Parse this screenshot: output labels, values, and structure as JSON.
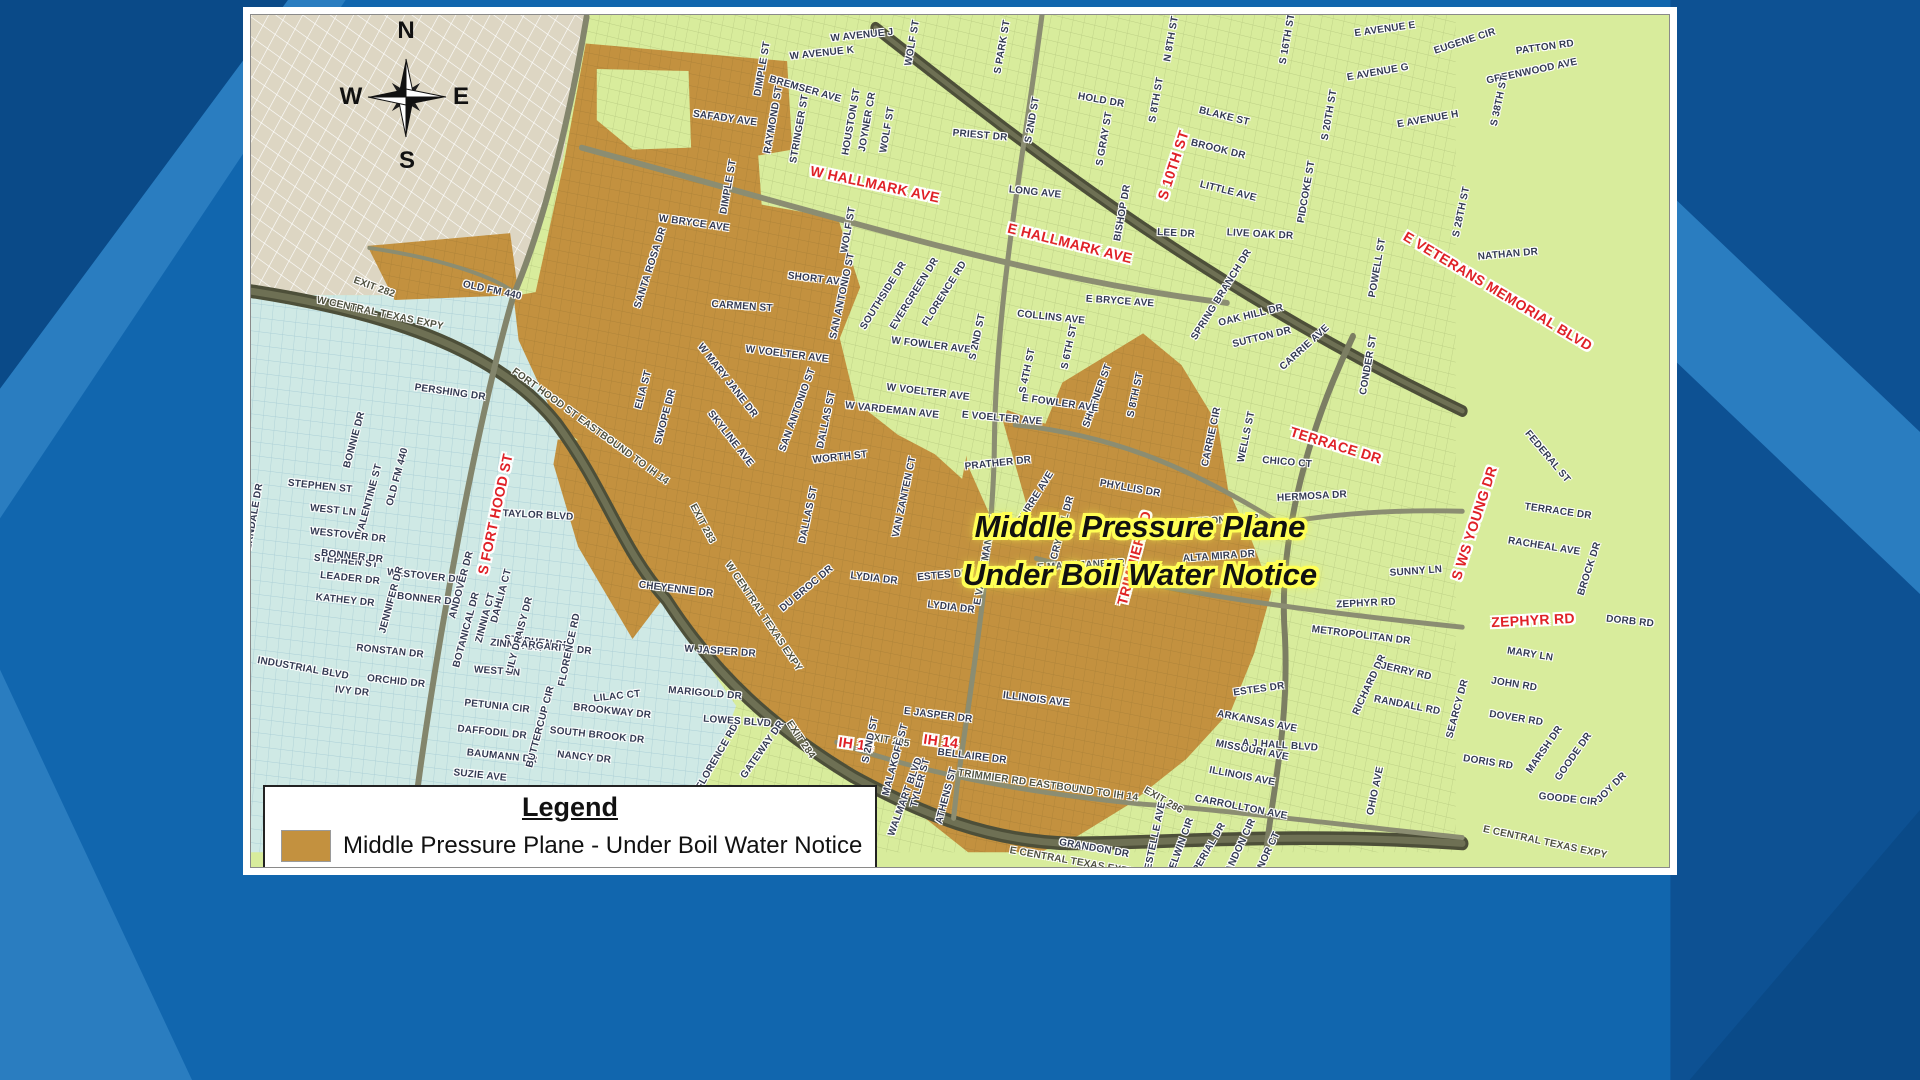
{
  "background": {
    "base": "#1166ae",
    "dark": "#0a4a88",
    "light": "#2a7dc0"
  },
  "map": {
    "compass": {
      "n": "N",
      "w": "W",
      "e": "E",
      "s": "S"
    },
    "notice": {
      "line1": "Middle Pressure Plane",
      "line2": "Under Boil Water Notice",
      "text_color": "#111111",
      "halo_color": "#ffff55"
    },
    "legend": {
      "title": "Legend",
      "item": "Middle Pressure Plane - Under Boil Water Notice",
      "swatch": "#c3913f"
    },
    "colors": {
      "boil_area": "#c3913f",
      "green_area": "#d8ec9c",
      "blue_area": "#cfe9e5",
      "beige_area": "#ddd6c3",
      "highway": "#4d4f39",
      "road": "#8b8d72",
      "red_label": "#e02127"
    },
    "labels": [
      [
        "EXIT 282",
        374,
        288,
        20,
        "ex"
      ],
      [
        "OLD FM 440",
        492,
        291,
        12,
        "st"
      ],
      [
        "W CENTRAL TEXAS EXPY",
        380,
        314,
        12,
        "ex"
      ],
      [
        "FORT HOOD ST EASTBOUND TO IH 14",
        590,
        427,
        36,
        "ex"
      ],
      [
        "EXIT 283",
        702,
        524,
        62,
        "ex"
      ],
      [
        "EXIT 284",
        800,
        740,
        56,
        "ex"
      ],
      [
        "W CENTRAL TEXAS EXPY",
        763,
        617,
        56,
        "ex"
      ],
      [
        "EXIT 285",
        888,
        741,
        10,
        "ex"
      ],
      [
        "EXIT 286",
        1163,
        801,
        30,
        "ex"
      ],
      [
        "TRIMMIER RD EASTBOUND TO IH 14",
        1048,
        786,
        8,
        "ex"
      ],
      [
        "E CENTRAL TEXAS EXPY",
        1072,
        862,
        10,
        "ex"
      ],
      [
        "E CENTRAL TEXAS EXPY",
        1545,
        843,
        12,
        "ex"
      ],
      [
        "W HALLMARK AVE",
        875,
        184,
        12,
        "hw"
      ],
      [
        "E HALLMARK AVE",
        1070,
        243,
        14,
        "hw"
      ],
      [
        "S 10TH ST",
        1173,
        165,
        -72,
        "hw"
      ],
      [
        "E VETERANS MEMORIAL BLVD",
        1498,
        291,
        31,
        "hw"
      ],
      [
        "TERRACE DR",
        1336,
        445,
        17,
        "hw"
      ],
      [
        "S WS YOUNG DR",
        1474,
        523,
        -72,
        "hw"
      ],
      [
        "ZEPHYR RD",
        1533,
        620,
        -3,
        "hw"
      ],
      [
        "TRIMMIER RD",
        1134,
        558,
        -75,
        "hw"
      ],
      [
        "S FORT HOOD ST",
        495,
        514,
        -78,
        "hw"
      ],
      [
        "IH 14",
        856,
        744,
        8,
        "hw"
      ],
      [
        "IH 14",
        941,
        741,
        8,
        "hw"
      ],
      [
        "W AVENUE J",
        862,
        36,
        -6,
        "st"
      ],
      [
        "W AVENUE K",
        822,
        54,
        -6,
        "st"
      ],
      [
        "WOLF ST",
        913,
        43,
        -80,
        "st"
      ],
      [
        "DIMPLE ST",
        763,
        69,
        -80,
        "st"
      ],
      [
        "BREMSER AVE",
        805,
        90,
        16,
        "st"
      ],
      [
        "SAFADY AVE",
        725,
        119,
        8,
        "st"
      ],
      [
        "RAYMOND ST",
        774,
        120,
        -80,
        "st"
      ],
      [
        "STRINGER ST",
        800,
        129,
        -80,
        "st"
      ],
      [
        "HOUSTON ST",
        852,
        122,
        -80,
        "st"
      ],
      [
        "JOYNER CR",
        868,
        122,
        -80,
        "st"
      ],
      [
        "WOLF ST",
        888,
        130,
        -80,
        "st"
      ],
      [
        "PRIEST DR",
        980,
        136,
        5,
        "st"
      ],
      [
        "S PARK ST",
        1003,
        47,
        -80,
        "st"
      ],
      [
        "N 8TH ST",
        1172,
        39,
        -80,
        "st"
      ],
      [
        "S 16TH ST",
        1288,
        39,
        -80,
        "st"
      ],
      [
        "S 2ND ST",
        1033,
        120,
        -80,
        "st"
      ],
      [
        "HOLD DR",
        1101,
        101,
        10,
        "st"
      ],
      [
        "S GRAY ST",
        1105,
        139,
        -80,
        "st"
      ],
      [
        "S 8TH ST",
        1157,
        100,
        -80,
        "st"
      ],
      [
        "BLAKE ST",
        1224,
        117,
        14,
        "st"
      ],
      [
        "BROOK DR",
        1218,
        150,
        14,
        "st"
      ],
      [
        "LITTLE AVE",
        1228,
        192,
        14,
        "st"
      ],
      [
        "S 20TH ST",
        1330,
        115,
        -80,
        "st"
      ],
      [
        "PIDCOKE ST",
        1307,
        192,
        -80,
        "st"
      ],
      [
        "LONG AVE",
        1035,
        193,
        6,
        "st"
      ],
      [
        "BISHOP DR",
        1123,
        213,
        -80,
        "st"
      ],
      [
        "LEE DR",
        1176,
        234,
        3,
        "st"
      ],
      [
        "LIVE OAK DR",
        1260,
        235,
        3,
        "st"
      ],
      [
        "E AVENUE E",
        1385,
        30,
        -8,
        "st"
      ],
      [
        "EUGENE CIR",
        1465,
        42,
        -18,
        "st"
      ],
      [
        "PATTON RD",
        1545,
        48,
        -8,
        "st"
      ],
      [
        "E AVENUE G",
        1378,
        73,
        -10,
        "st"
      ],
      [
        "GREENWOOD AVE",
        1532,
        72,
        -12,
        "st"
      ],
      [
        "E AVENUE H",
        1428,
        120,
        -10,
        "st"
      ],
      [
        "S 38TH ST",
        1500,
        101,
        -78,
        "st"
      ],
      [
        "S 28TH ST",
        1462,
        212,
        -78,
        "st"
      ],
      [
        "POWELL ST",
        1378,
        268,
        -80,
        "st"
      ],
      [
        "NATHAN DR",
        1508,
        255,
        -5,
        "st"
      ],
      [
        "CONDER ST",
        1369,
        365,
        -80,
        "st"
      ],
      [
        "E BRYCE AVE",
        1120,
        302,
        4,
        "st"
      ],
      [
        "COLLINS AVE",
        1051,
        318,
        6,
        "st"
      ],
      [
        "S 4TH ST",
        1028,
        371,
        -78,
        "st"
      ],
      [
        "S 6TH ST",
        1070,
        347,
        -78,
        "st"
      ],
      [
        "S 8TH ST",
        1136,
        395,
        -78,
        "st"
      ],
      [
        "SHOFNER ST",
        1098,
        396,
        -70,
        "st"
      ],
      [
        "E FOWLER AVE",
        1060,
        404,
        8,
        "st"
      ],
      [
        "SPRING BRANCH DR",
        1222,
        295,
        -58,
        "st"
      ],
      [
        "OAK HILL DR",
        1251,
        316,
        -14,
        "st"
      ],
      [
        "SUTTON DR",
        1262,
        338,
        -14,
        "st"
      ],
      [
        "CARRIE AVE",
        1305,
        348,
        -42,
        "st"
      ],
      [
        "FEDERAL ST",
        1547,
        457,
        50,
        "st"
      ],
      [
        "TERRACE DR",
        1558,
        512,
        8,
        "st"
      ],
      [
        "RACHEAL AVE",
        1544,
        547,
        9,
        "st"
      ],
      [
        "BROCK DR",
        1590,
        569,
        -72,
        "st"
      ],
      [
        "SUNNY LN",
        1416,
        572,
        -4,
        "st"
      ],
      [
        "MARY LN",
        1530,
        655,
        9,
        "st"
      ],
      [
        "JOHN RD",
        1514,
        685,
        9,
        "st"
      ],
      [
        "DOVER RD",
        1516,
        719,
        9,
        "st"
      ],
      [
        "DORIS RD",
        1488,
        763,
        9,
        "st"
      ],
      [
        "MARSH DR",
        1545,
        750,
        -55,
        "st"
      ],
      [
        "GOODE DR",
        1574,
        757,
        -55,
        "st"
      ],
      [
        "GOODE CIR",
        1568,
        800,
        6,
        "st"
      ],
      [
        "JOY DR",
        1612,
        788,
        -45,
        "st"
      ],
      [
        "DORB RD",
        1630,
        622,
        6,
        "st"
      ],
      [
        "SANTA ROSA DR",
        651,
        268,
        -72,
        "st"
      ],
      [
        "W BRYCE AVE",
        694,
        224,
        8,
        "st"
      ],
      [
        "DIMPLE ST",
        729,
        187,
        -80,
        "st"
      ],
      [
        "SHORT AVE",
        817,
        280,
        7,
        "st"
      ],
      [
        "CARMEN ST",
        742,
        307,
        4,
        "st"
      ],
      [
        "SAN ANTONIO ST",
        843,
        296,
        -78,
        "st"
      ],
      [
        "SAN ANTONIO ST",
        798,
        410,
        -70,
        "st"
      ],
      [
        "W VOELTER AVE",
        787,
        355,
        7,
        "st"
      ],
      [
        "W VOELTER AVE",
        928,
        393,
        7,
        "st"
      ],
      [
        "W MARY JANE DR",
        727,
        381,
        52,
        "st"
      ],
      [
        "SWOPE DR",
        666,
        417,
        -75,
        "st"
      ],
      [
        "ELIA ST",
        644,
        390,
        -75,
        "st"
      ],
      [
        "SKYLINE AVE",
        730,
        439,
        52,
        "st"
      ],
      [
        "DALLAS ST",
        827,
        420,
        -78,
        "st"
      ],
      [
        "DALLAS ST",
        809,
        515,
        -78,
        "st"
      ],
      [
        "WORTH ST",
        840,
        458,
        -6,
        "st"
      ],
      [
        "W VARDEMAN AVE",
        892,
        411,
        6,
        "st"
      ],
      [
        "VAN ZANTEN CT",
        905,
        497,
        -78,
        "st"
      ],
      [
        "SOUTHSIDE DR",
        884,
        296,
        -58,
        "st"
      ],
      [
        "EVERGREEN DR",
        915,
        294,
        -58,
        "st"
      ],
      [
        "FLORENCE RD",
        945,
        294,
        -58,
        "st"
      ],
      [
        "WOLF ST",
        849,
        230,
        -80,
        "st"
      ],
      [
        "W FOWLER AVE",
        931,
        346,
        7,
        "st"
      ],
      [
        "PRATHER DR",
        998,
        464,
        -6,
        "st"
      ],
      [
        "CURRE AVE",
        1036,
        498,
        -58,
        "st"
      ],
      [
        "CRYSTAL DR",
        1063,
        528,
        -75,
        "st"
      ],
      [
        "E MARY JANE DR",
        1081,
        566,
        -3,
        "st"
      ],
      [
        "LYDIA DR",
        874,
        579,
        7,
        "st"
      ],
      [
        "LYDIA DR",
        951,
        608,
        7,
        "st"
      ],
      [
        "ESTES DR",
        943,
        576,
        -5,
        "st"
      ],
      [
        "ESTES DR",
        1259,
        690,
        -8,
        "st"
      ],
      [
        "E VARDEMAN AVE",
        986,
        560,
        -80,
        "st"
      ],
      [
        "E VOELTER AVE",
        1002,
        419,
        5,
        "st"
      ],
      [
        "S 2ND ST",
        978,
        337,
        -78,
        "st"
      ],
      [
        "S 2ND ST",
        871,
        740,
        -78,
        "st"
      ],
      [
        "E JASPER DR",
        938,
        716,
        7,
        "st"
      ],
      [
        "W JASPER DR",
        720,
        652,
        4,
        "st"
      ],
      [
        "BELLAIRE DR",
        972,
        757,
        7,
        "st"
      ],
      [
        "MALAKOFF ST",
        896,
        760,
        -75,
        "st"
      ],
      [
        "TYLER ST",
        921,
        783,
        -75,
        "st"
      ],
      [
        "ATHENS ST",
        947,
        796,
        -75,
        "st"
      ],
      [
        "ILLINOIS AVE",
        1036,
        700,
        7,
        "st"
      ],
      [
        "ILLINOIS AVE",
        1242,
        777,
        11,
        "st"
      ],
      [
        "MISSOURI AVE",
        1252,
        751,
        11,
        "st"
      ],
      [
        "ARKANSAS AVE",
        1257,
        722,
        11,
        "st"
      ],
      [
        "CARROLLTON AVE",
        1241,
        808,
        11,
        "st"
      ],
      [
        "GRANDON DR",
        1094,
        849,
        10,
        "st"
      ],
      [
        "ESTELLE AVE",
        1156,
        836,
        -78,
        "st"
      ],
      [
        "DELWIN CIR",
        1181,
        847,
        -70,
        "st"
      ],
      [
        "IMPERIAL DR",
        1207,
        853,
        -60,
        "st"
      ],
      [
        "GRANDON CIR",
        1238,
        853,
        -65,
        "st"
      ],
      [
        "MANOR CT",
        1266,
        858,
        -65,
        "st"
      ],
      [
        "OHIO AVE",
        1376,
        791,
        -78,
        "st"
      ],
      [
        "REDONDO DR",
        1224,
        521,
        -4,
        "st"
      ],
      [
        "ALTA MIRA DR",
        1219,
        557,
        -4,
        "st"
      ],
      [
        "HERMOSA DR",
        1312,
        497,
        -3,
        "st"
      ],
      [
        "CHICO CT",
        1287,
        463,
        5,
        "st"
      ],
      [
        "WELLS ST",
        1247,
        437,
        -78,
        "st"
      ],
      [
        "CARRIE CIR",
        1212,
        437,
        -78,
        "st"
      ],
      [
        "PHYLLIS DR",
        1130,
        489,
        10,
        "st"
      ],
      [
        "ZEPHYR RD",
        1366,
        604,
        -3,
        "st"
      ],
      [
        "METROPOLITAN DR",
        1361,
        636,
        7,
        "st"
      ],
      [
        "RICHARD DR",
        1370,
        685,
        -65,
        "st"
      ],
      [
        "JERRY RD",
        1406,
        672,
        13,
        "st"
      ],
      [
        "RANDALL RD",
        1407,
        706,
        11,
        "st"
      ],
      [
        "SEARCY DR",
        1458,
        709,
        -75,
        "st"
      ],
      [
        "A J HALL BLVD",
        1280,
        746,
        4,
        "st"
      ],
      [
        "CHEYENNE DR",
        676,
        590,
        7,
        "st"
      ],
      [
        "DU BROC DR",
        807,
        589,
        -40,
        "st"
      ],
      [
        "PERSHING DR",
        450,
        393,
        8,
        "st"
      ],
      [
        "BONNIE DR",
        355,
        440,
        -75,
        "st"
      ],
      [
        "VALENTINE ST",
        370,
        500,
        -75,
        "st"
      ],
      [
        "OLD FM 440",
        398,
        477,
        -75,
        "st"
      ],
      [
        "TAYLOR BLVD",
        538,
        516,
        3,
        "st"
      ],
      [
        "STEPHEN ST",
        320,
        487,
        6,
        "st"
      ],
      [
        "STEPHEN ST",
        346,
        562,
        6,
        "st"
      ],
      [
        "WEST LN",
        333,
        511,
        6,
        "st"
      ],
      [
        "WEST LN",
        497,
        672,
        4,
        "st"
      ],
      [
        "WESTOVER DR",
        348,
        536,
        6,
        "st"
      ],
      [
        "WESTOVER DR",
        425,
        577,
        6,
        "st"
      ],
      [
        "BONNER DR",
        352,
        557,
        6,
        "st"
      ],
      [
        "BONNER DR",
        428,
        600,
        6,
        "st"
      ],
      [
        "LEADER DR",
        350,
        579,
        6,
        "st"
      ],
      [
        "KATHEY DR",
        345,
        601,
        6,
        "st"
      ],
      [
        "FERNDALE DR",
        254,
        520,
        -80,
        "st"
      ],
      [
        "JENNIFER DR",
        392,
        600,
        -75,
        "st"
      ],
      [
        "ANDOVER DR",
        462,
        585,
        -75,
        "st"
      ],
      [
        "STEPHEN DR",
        537,
        643,
        6,
        "st"
      ],
      [
        "LILAC CT",
        617,
        697,
        -6,
        "st"
      ],
      [
        "MARIGOLD DR",
        705,
        694,
        5,
        "st"
      ],
      [
        "DAHLIA CT",
        502,
        596,
        -75,
        "st"
      ],
      [
        "ZINNIA CT",
        486,
        618,
        -75,
        "st"
      ],
      [
        "DAISY DR",
        524,
        621,
        -75,
        "st"
      ],
      [
        "ZINNIA DR",
        516,
        646,
        6,
        "st"
      ],
      [
        "BOTANICAL DR",
        467,
        630,
        -75,
        "st"
      ],
      [
        "MARGARITA DR",
        552,
        648,
        6,
        "st"
      ],
      [
        "RONSTAN DR",
        390,
        652,
        6,
        "st"
      ],
      [
        "ORCHID DR",
        396,
        682,
        6,
        "st"
      ],
      [
        "IVY DR",
        352,
        692,
        6,
        "st"
      ],
      [
        "INDUSTRIAL BLVD",
        303,
        669,
        10,
        "st"
      ],
      [
        "PETUNIA CIR",
        497,
        707,
        6,
        "st"
      ],
      [
        "DAFFODIL DR",
        492,
        733,
        6,
        "st"
      ],
      [
        "BAUMANN DR",
        502,
        757,
        6,
        "st"
      ],
      [
        "SUZIE AVE",
        480,
        776,
        6,
        "st"
      ],
      [
        "BUTTERCUP CIR",
        541,
        727,
        -75,
        "st"
      ],
      [
        "SOUTH BROOK DR",
        597,
        736,
        6,
        "st"
      ],
      [
        "NANCY DR",
        584,
        758,
        6,
        "st"
      ],
      [
        "BROOKWAY DR",
        612,
        712,
        6,
        "st"
      ],
      [
        "LILY DR",
        515,
        655,
        -75,
        "st"
      ],
      [
        "FLORENCE RD",
        570,
        650,
        -78,
        "st"
      ],
      [
        "FLORENCE RD",
        718,
        757,
        -60,
        "st"
      ],
      [
        "LOWES BLVD",
        737,
        722,
        4,
        "st"
      ],
      [
        "GATEWAY DR",
        763,
        750,
        -55,
        "st"
      ],
      [
        "WALMART BLVD",
        906,
        797,
        -70,
        "st"
      ]
    ]
  }
}
